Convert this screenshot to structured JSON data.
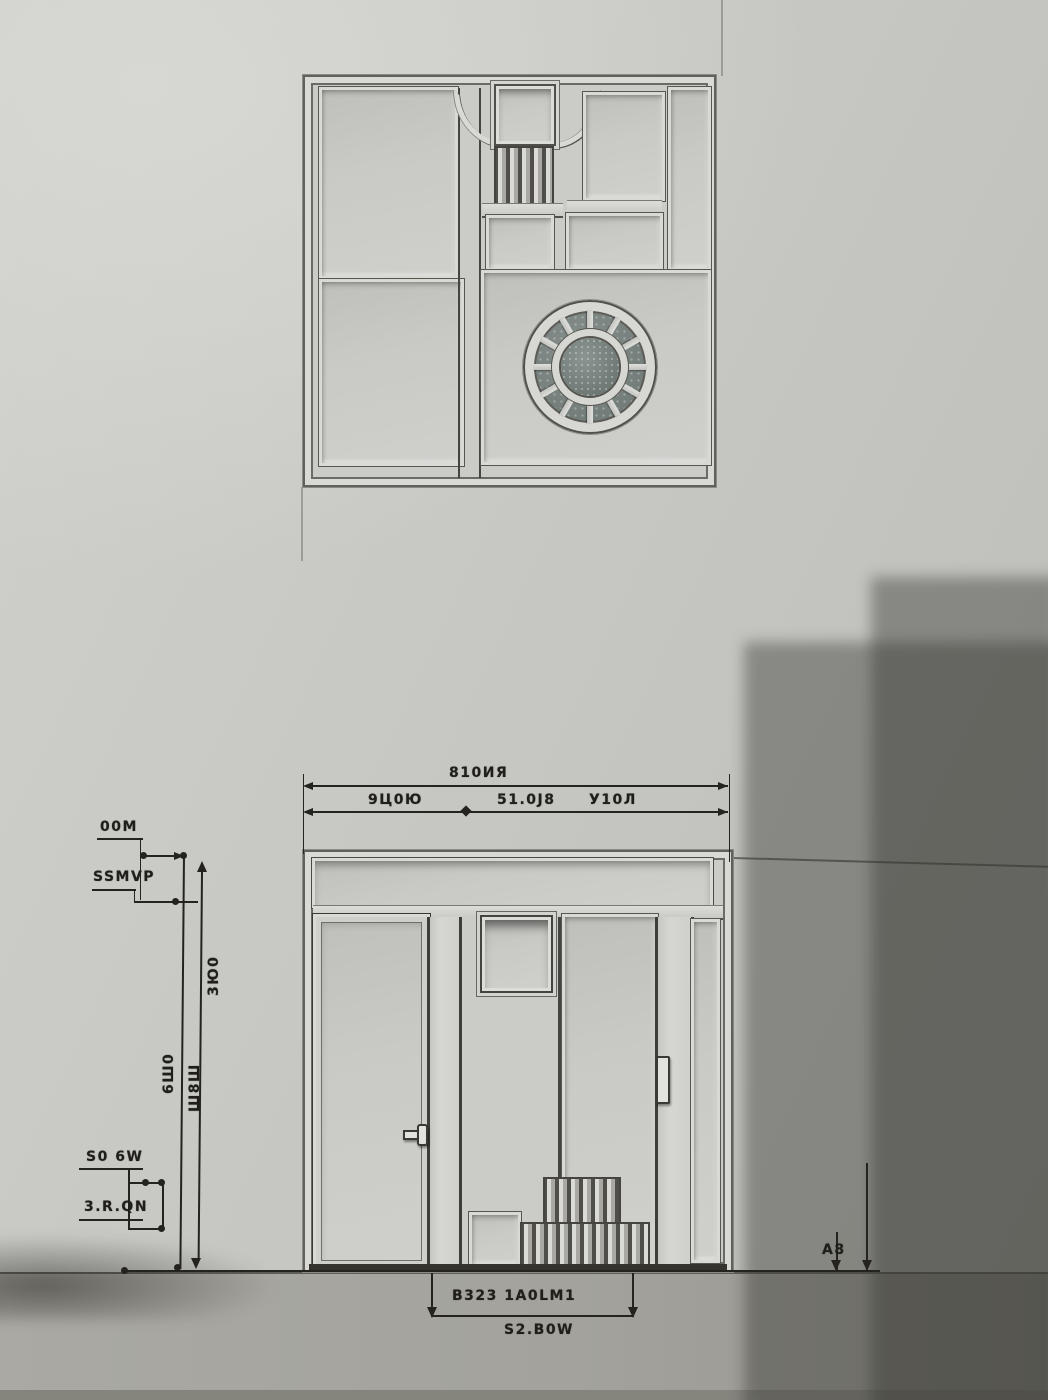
{
  "scene": {
    "description": "Photographed art-deco stucco facade relief annotated like an architectural elevation drawing",
    "upper_relief": "square molded panel with geometric sub-panels, slat grille ornament and round rosette window",
    "lower_relief": "storefront elevation with transom band, two door leaves, small inset pane and stepped vent grille",
    "shadow": "stepped building shadow cast over right side of wall"
  },
  "colors": {
    "wall_lit": "#c9c9c5",
    "wall_shadow": "#8e8c87",
    "ground": "#a3a29c",
    "molding": "#d9d9d5",
    "panel_recess": "#c2c2be",
    "outline": "#55544e",
    "ink": "#24231d",
    "rosette_glass": "#74807d"
  },
  "annotations": {
    "top_total": "810ИЯ",
    "top_seg_left": "9Ц0Ю",
    "top_seg_mid": "51.0Ј8",
    "top_seg_right": "У10Л",
    "left_upper_a": "00M",
    "left_upper_b": "SSMVP",
    "vert_a": "3Ю0",
    "vert_b": "6Ш0",
    "vert_c": "Ш8Ш",
    "left_lower_a": "S0 6W",
    "left_lower_b": "3.R.QN",
    "right_offset": "A8",
    "bottom_width": "B323 1A0LM1",
    "bottom_total": "S2.B0W"
  }
}
